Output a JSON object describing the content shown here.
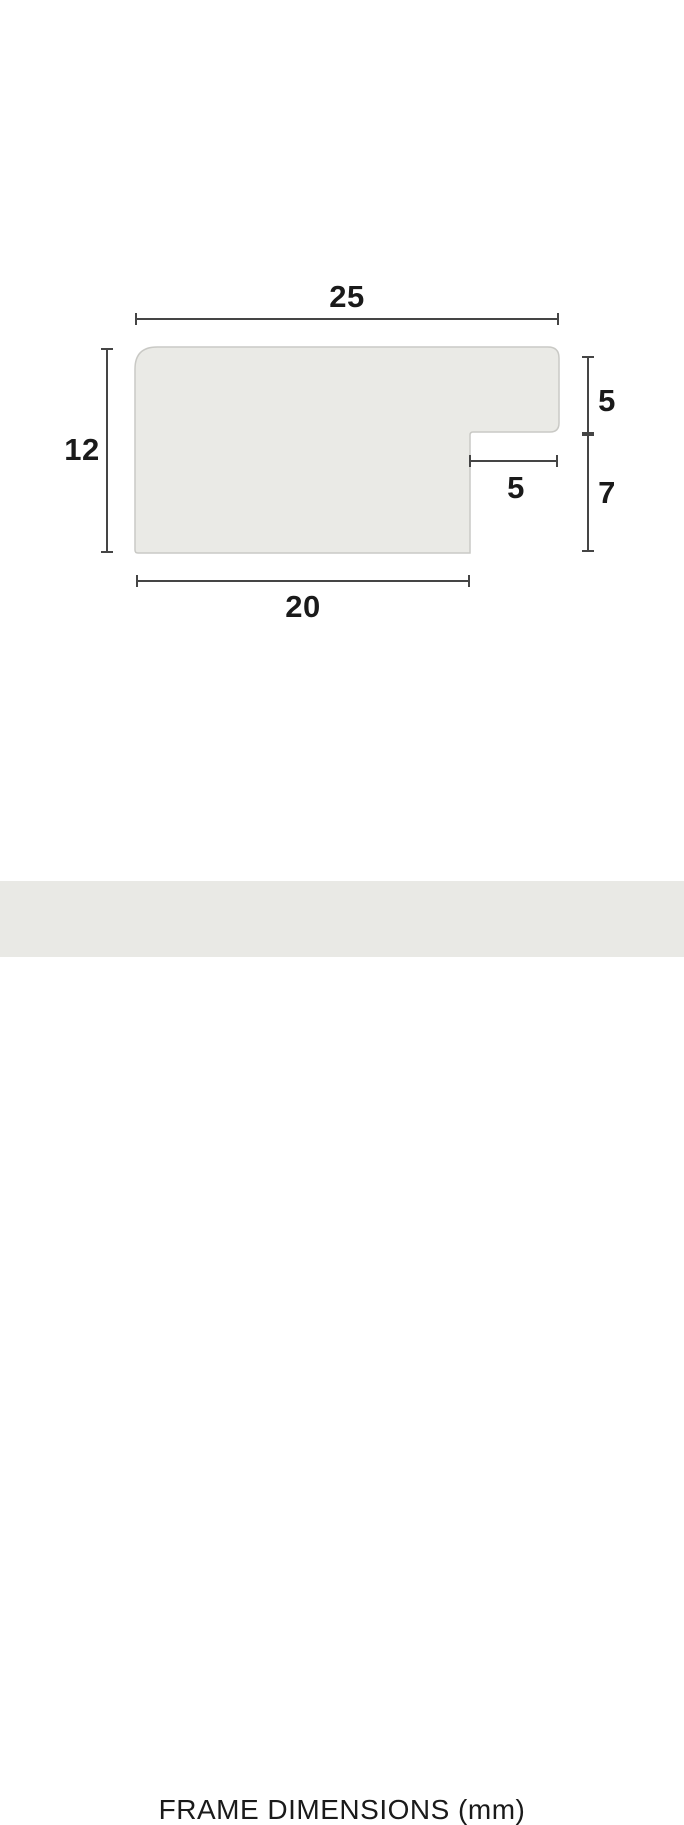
{
  "diagram": {
    "labels": {
      "top_width": "25",
      "left_height": "12",
      "right_upper_height": "5",
      "rabbet_width": "5",
      "right_lower_height": "7",
      "bottom_width": "20"
    }
  },
  "footer": {
    "title": "FRAME DIMENSIONS (mm)"
  },
  "colors": {
    "background": "#ffffff",
    "shape_fill": "#eaeae6",
    "shape_border": "#c9c9c5",
    "dimension_line": "#454545",
    "label_text": "#1a1a1a",
    "footer_bg": "#e9e9e5"
  }
}
